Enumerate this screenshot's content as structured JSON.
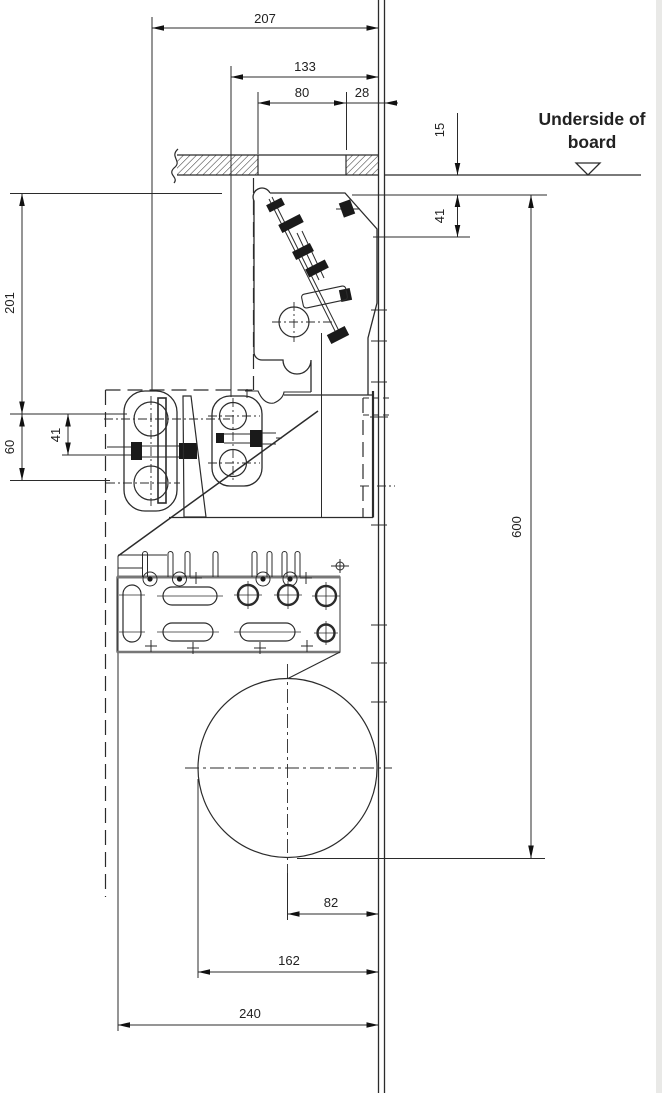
{
  "drawing": {
    "note": {
      "line1": "Underside of",
      "line2": "board"
    },
    "dimensions": {
      "overall_top": "207",
      "inner_top": "133",
      "slot_width": "80",
      "wall_offset": "28",
      "board_drop": "15",
      "upper_right_gap": "41",
      "left_height": "201",
      "roller_spacing": "60",
      "roller_to_bolt": "41",
      "total_height": "600",
      "bottom_inner": "82",
      "bottom_mid": "162",
      "bottom_overall": "240"
    },
    "colors": {
      "line": "#2b2b2b",
      "background": "#ffffff"
    }
  }
}
